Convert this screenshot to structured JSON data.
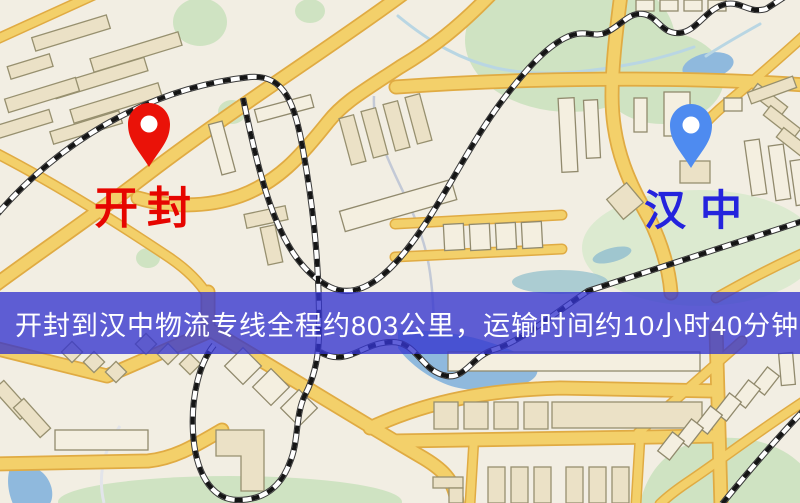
{
  "banner": {
    "text": "开封到汉中物流专线全程约803公里，运输时间约10小时40分钟.",
    "background": "#3434ce",
    "text_color": "#ffffff"
  },
  "origin_marker": {
    "label": "开封",
    "label_color": "#e60500",
    "pin_color": "#ea1208"
  },
  "destination_marker": {
    "label": "汉中",
    "label_color": "#2424dd",
    "pin_color": "#4e8bf0"
  },
  "route_summary": {
    "from": "开封",
    "to": "汉中",
    "distance_text": "约803公里",
    "duration_text": "约10小时40分钟"
  },
  "map_palette": {
    "background": "#f2eee3",
    "road": "#f3d06a",
    "road_casing": "#e0ab43",
    "building": "#ebe1c6",
    "building_outline": "#97906f",
    "park": "#cfe3c2",
    "water": "#8fb9dd",
    "railway": "#151515"
  }
}
